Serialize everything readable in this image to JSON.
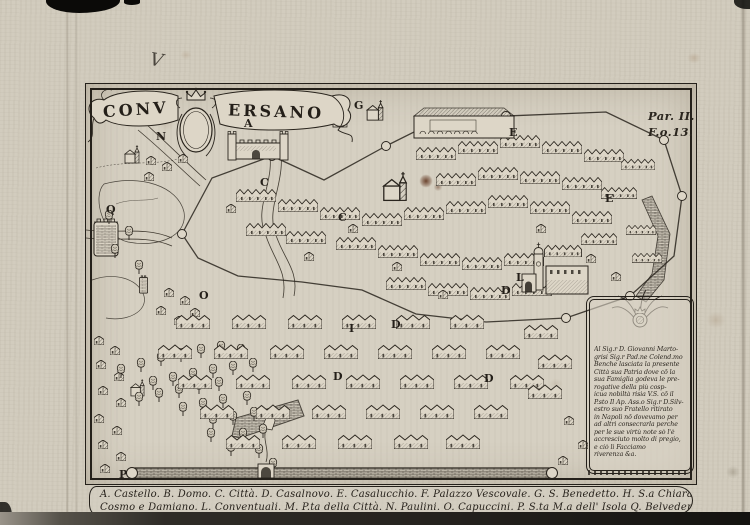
{
  "banner": {
    "left": "CONV",
    "right": "ERSANO"
  },
  "margin_note": {
    "line1": "Par. II.",
    "line2": "F.o.13."
  },
  "handwritten_mark": "V",
  "map": {
    "letters": [
      {
        "ch": "N"
      },
      {
        "ch": "A"
      },
      {
        "ch": "G"
      },
      {
        "ch": "C"
      },
      {
        "ch": "C"
      },
      {
        "ch": "E"
      },
      {
        "ch": "E"
      },
      {
        "ch": "D"
      },
      {
        "ch": "L"
      },
      {
        "ch": "I"
      },
      {
        "ch": "D"
      },
      {
        "ch": "D"
      },
      {
        "ch": "D"
      },
      {
        "ch": "O"
      },
      {
        "ch": "Q"
      },
      {
        "ch": "P"
      }
    ]
  },
  "cartouche": {
    "lines": [
      "Al Sig.r D. Giovanni Marto-",
      "grisi Sig.r Pad.ne Colend.mo",
      "Benche lasciata la presente",
      "Città sua Patria dove cō la",
      "sua Famiglia godeva le pre-",
      "rogative della più cosp-",
      "icua nobiltà risia V.S. cō il",
      "P.sto Il Ap. Ass.o Sig.r D.Silv-",
      "estro suo Fratello ritirato",
      "in Napoli nō dovevamo per",
      "ad altri consecrarla perche",
      "per le sue virtù note sò l'è",
      "accresciuto molto di pregio,",
      "e ciò li Facciamo",
      "riverenza &a."
    ]
  },
  "legend": {
    "line1": "A. Castello. B. Domo. C. Città. D. Casalnovo. E. Casalucchio. F. Palazzo Vescovale. G. S. Benedetto. H. S.a Chiara. I. SS.",
    "line2": "Cosmo e Damiano. L. Conventuali. M. P.ta della Città. N. Paulini. O. Capuccini. P. S.ta M.a dell' Isola Q. Belvedere detto il Palo."
  },
  "colors": {
    "paper": "#d5cfc1",
    "ink": "#29241d",
    "stain": "#6b3c28"
  }
}
